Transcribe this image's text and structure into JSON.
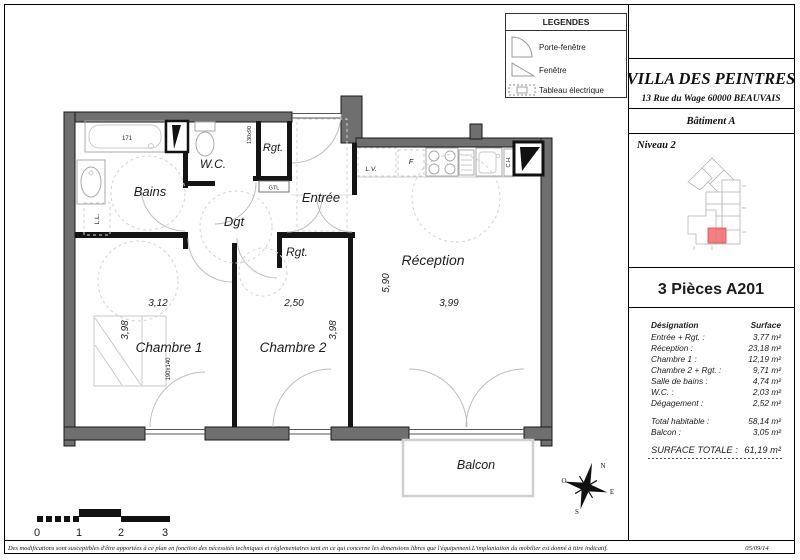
{
  "legend": {
    "title": "LEGENDES",
    "items": [
      {
        "icon": "porte-fenetre-icon",
        "label": "Porte-fenêtre"
      },
      {
        "icon": "fenetre-icon",
        "label": "Fenêtre"
      },
      {
        "icon": "tableau-electrique-icon",
        "label": "Tableau électrique"
      }
    ]
  },
  "title_block": {
    "project": "VILLA DES PEINTRES",
    "address": "13 Rue du Wage 60000 BEAUVAIS",
    "building": "Bâtiment A",
    "level": "Niveau 2",
    "unit": "3 Pièces A201"
  },
  "surface_table": {
    "col_designation": "Désignation",
    "col_surface": "Surface",
    "rows": [
      {
        "label": "Entrée + Rgt. :",
        "value": "3,77 m²"
      },
      {
        "label": "Réception :",
        "value": "23,18 m²"
      },
      {
        "label": "Chambre 1 :",
        "value": "12,19 m²"
      },
      {
        "label": "Chambre 2 + Rgt. :",
        "value": "9,71 m²"
      },
      {
        "label": "Salle de bains :",
        "value": "4,74 m²"
      },
      {
        "label": "W.C. :",
        "value": "2,03 m²"
      },
      {
        "label": "Dégagement :",
        "value": "2,52 m²"
      }
    ],
    "subtotals": [
      {
        "label": "Total habitable :",
        "value": "58,14 m²"
      },
      {
        "label": "Balcon :",
        "value": "3,05 m²"
      }
    ],
    "total": {
      "label": "SURFACE TOTALE :",
      "value": "61,19 m²"
    }
  },
  "plan": {
    "rooms": {
      "bains": "Bains",
      "wc": "W.C.",
      "rgt1": "Rgt.",
      "entree": "Entrée",
      "dgt": "Dgt",
      "rgt2": "Rgt.",
      "chambre1": "Chambre 1",
      "chambre2": "Chambre 2",
      "reception": "Réception",
      "balcon": "Balcon"
    },
    "dimensions": {
      "chambre1_width": "3,12",
      "chambre1_height": "3,98",
      "chambre2_width": "2,50",
      "chambre2_height": "3,98",
      "reception_width": "3,99",
      "reception_height": "5,90"
    },
    "annotations": {
      "bathtub": "171",
      "bed": "190x140",
      "closet": "130x90",
      "gtl": "GTL",
      "dishwasher": "L.V.",
      "fridge": "F",
      "boiler": "C.H.",
      "washer": "L.L."
    }
  },
  "compass": {
    "north": "N",
    "south": "S",
    "east": "E",
    "west": "O"
  },
  "scale_bar": {
    "labels": [
      "0",
      "1",
      "2",
      "3"
    ]
  },
  "footer": {
    "disclaimer": "Des modifications sont susceptibles d'être apportées à ce plan en fonction des nécessités techniques et réglementaires tant en ce qui concerne les dimensions libres que l'équipement.L'implantation du mobilier est donné à titre indicatif.",
    "date": "05/09/14"
  }
}
